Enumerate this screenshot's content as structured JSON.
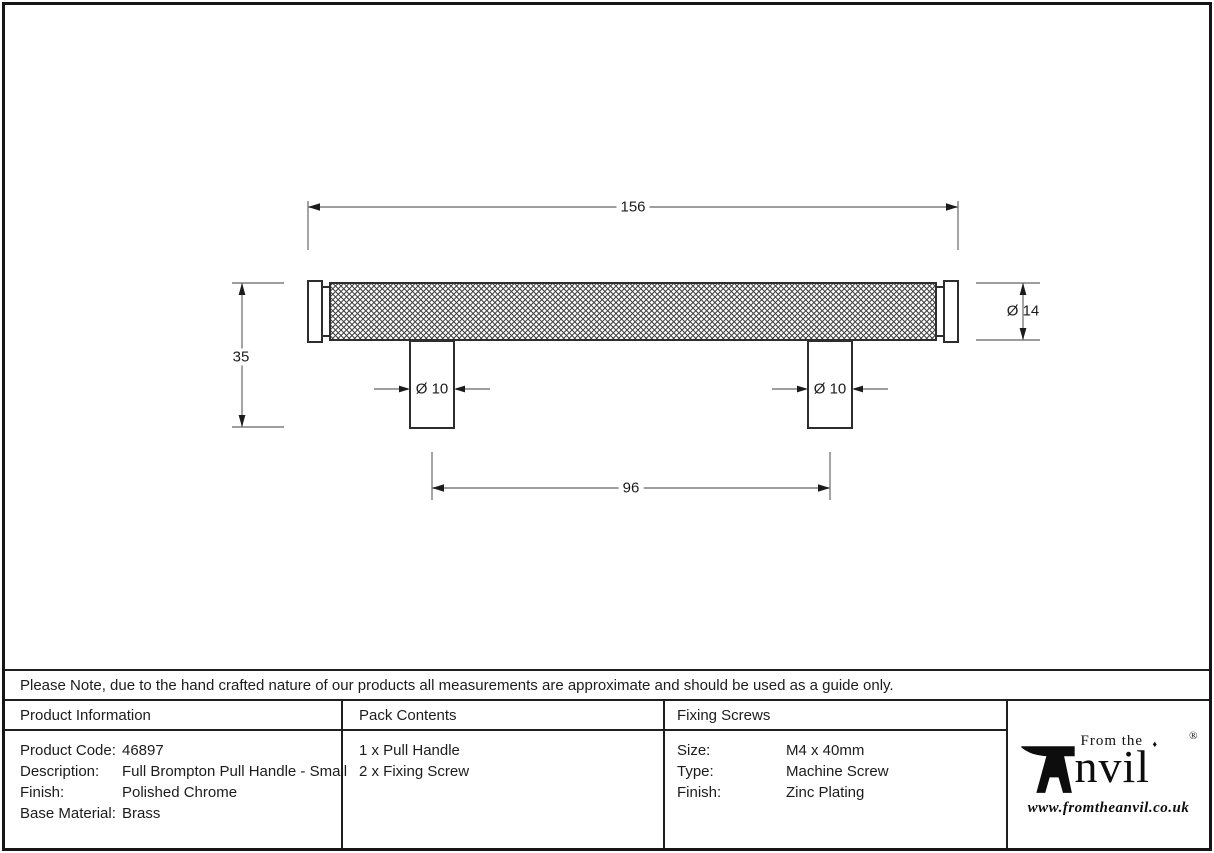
{
  "note": {
    "text": "Please Note, due to the hand crafted nature of our products all measurements are approximate and should be used as a guide only."
  },
  "drawing": {
    "dimensions": {
      "overall_length": "156",
      "overall_height": "35",
      "post_diameter": "Ø 10",
      "end_diameter": "Ø 14",
      "fixing_centres": "96"
    }
  },
  "table": {
    "product_information": {
      "header": "Product Information",
      "rows": [
        {
          "label": "Product Code:",
          "value": "46897"
        },
        {
          "label": "Description:",
          "value": "Full Brompton Pull Handle - Small"
        },
        {
          "label": "Finish:",
          "value": "Polished Chrome"
        },
        {
          "label": "Base Material:",
          "value": "Brass"
        }
      ]
    },
    "pack_contents": {
      "header": "Pack Contents",
      "items": [
        "1 x Pull Handle",
        "2 x Fixing Screw"
      ]
    },
    "fixing_screws": {
      "header": "Fixing Screws",
      "rows": [
        {
          "label": "Size:",
          "value": "M4 x 40mm"
        },
        {
          "label": "Type:",
          "value": "Machine Screw"
        },
        {
          "label": "Finish:",
          "value": "Zinc Plating"
        }
      ]
    }
  },
  "logo": {
    "prefix": "From the",
    "name_remainder": "nvil",
    "diamond": "♦",
    "registered": "®",
    "url": "www.fromtheanvil.co.uk"
  },
  "colors": {
    "object_line": "#2d2d2d",
    "dimension_line": "#7e7e7e",
    "ink": "#1c1c1c"
  }
}
